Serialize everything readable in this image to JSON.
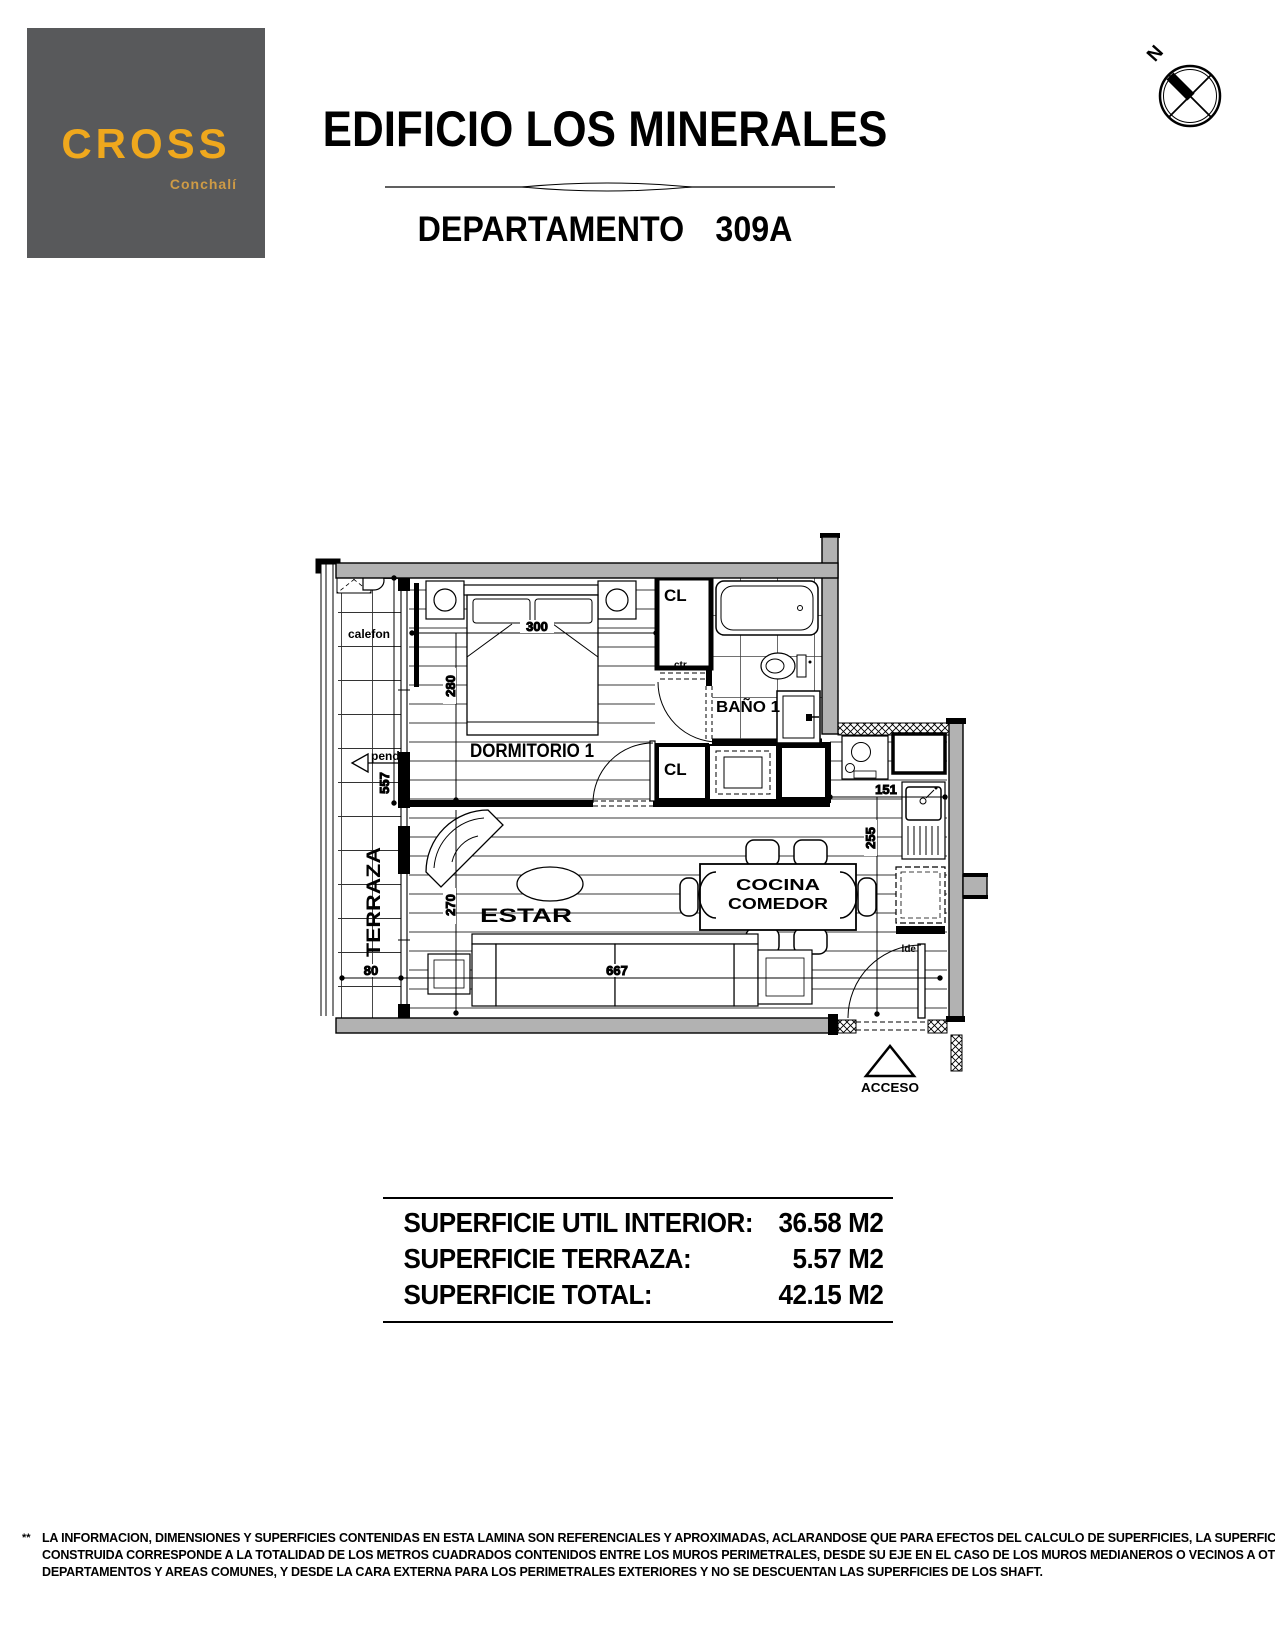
{
  "header": {
    "logo": {
      "brand": "CROSS",
      "location": "Conchalí"
    },
    "title": "EDIFICIO LOS MINERALES",
    "dept_label": "DEPARTAMENTO",
    "dept_number": "309A",
    "compass_north": "N"
  },
  "plan": {
    "rooms": {
      "terraza": "TERRAZA",
      "dormitorio": "DORMITORIO 1",
      "estar": "ESTAR",
      "cocina_line1": "COCINA",
      "cocina_line2": "COMEDOR",
      "bano": "BAÑO 1",
      "closet1": "CL",
      "closet2": "CL"
    },
    "annotations": {
      "calefon": "calefon",
      "pend": "pend.",
      "ctr": "ctr",
      "lde": "lde",
      "acceso": "ACCESO"
    },
    "dims": {
      "d300": "300",
      "d280": "280",
      "d557": "557",
      "d80": "80",
      "d667": "667",
      "d270": "270",
      "d151": "151",
      "d255": "255"
    }
  },
  "areas": {
    "rows": [
      {
        "label": "SUPERFICIE UTIL INTERIOR:",
        "value": "36.58 M2"
      },
      {
        "label": "SUPERFICIE TERRAZA:",
        "value": "5.57 M2"
      },
      {
        "label": "SUPERFICIE TOTAL:",
        "value": "42.15 M2"
      }
    ]
  },
  "disclaimer": {
    "marker": "**",
    "lines": [
      "LA INFORMACION, DIMENSIONES Y SUPERFICIES CONTENIDAS EN ESTA LAMINA SON REFERENCIALES Y APROXIMADAS, ACLARANDOSE QUE PARA EFECTOS DEL CALCULO DE SUPERFICIES,  LA  SUPERFICIE",
      "CONSTRUIDA CORRESPONDE A LA TOTALIDAD DE LOS METROS CUADRADOS CONTENIDOS ENTRE LOS MUROS PERIMETRALES, DESDE SU EJE EN EL CASO DE LOS MUROS MEDIANEROS O VECINOS A OTROS",
      "DEPARTAMENTOS Y AREAS COMUNES, Y DESDE LA CARA EXTERNA PARA LOS PERIMETRALES EXTERIORES Y NO SE DESCUENTAN LAS SUPERFICIES DE LOS SHAFT."
    ]
  },
  "colors": {
    "wall_fill": "#b2b2b2",
    "logo_background": "#58595b",
    "logo_accent": "#efa81d",
    "line": "#000000"
  }
}
